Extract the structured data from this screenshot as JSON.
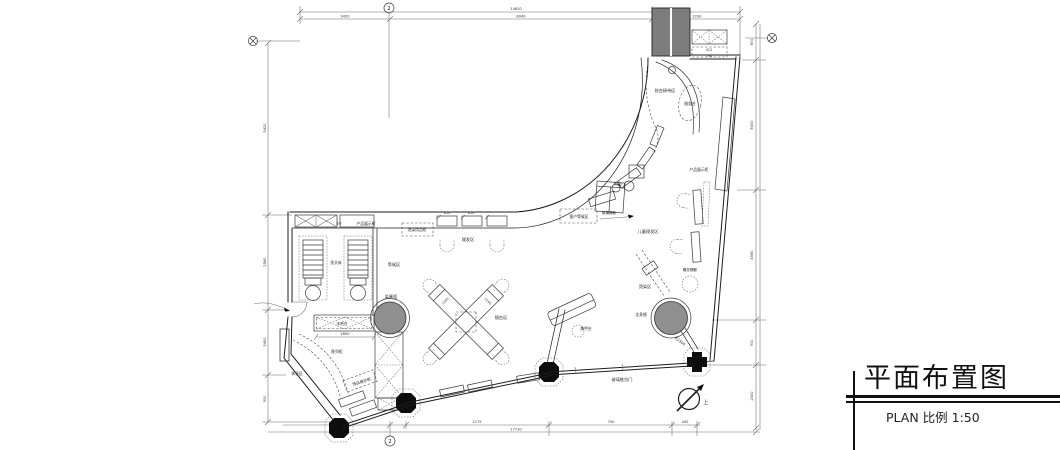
{
  "title_block": {
    "title": "平面布置图",
    "subtitle": "PLAN 比例  1:50"
  },
  "plan": {
    "bubbles": {
      "top": "2",
      "bottom": "2"
    },
    "labels": {
      "tv": "TV",
      "display_top": "产品展示柜",
      "dye_cabinet": "烫染用品柜",
      "shampoo_bed": "洗头床",
      "waiting_area": "等候区",
      "dye_room": "染膏柜",
      "cut_area": "理发区",
      "mirror_island": "镜台区",
      "water_bar": "水吧台",
      "display_cab_left": "陈列柜",
      "jewelry_display": "饰品展示柜",
      "rest_area": "休息区",
      "reception_desk": "服务台",
      "front_desk_area": "前台接待区",
      "display_cab_right": "产品展示柜",
      "guest_waiting": "客户等候区",
      "tea_table": "茶几",
      "glass_partition": "玻璃隔断",
      "kids_cut": "儿童理发区",
      "perm_area": "烫染区",
      "full_mirror": "全身镜",
      "len_2500": "长2500",
      "nail_table": "美甲台",
      "glass_door": "玻璃推拉门",
      "kt": "KT",
      "carved_screen": "雕花隔断",
      "north": "上"
    },
    "dims": {
      "top_total": "14620",
      "top_a": "3420",
      "top_b": "8040",
      "top_c": "2230",
      "left_a": "5420",
      "left_b": "2560",
      "left_c": "3400",
      "left_d": "900",
      "right_e": "800",
      "right_a": "8000",
      "right_d": "4060",
      "right_b": "900",
      "right_c": "2000",
      "bottom_a": "2175",
      "bottom_c": "750",
      "bottom_d": "440",
      "bottom_total": "17710",
      "bar_len": "2600",
      "island_a": "1150",
      "island_b": "1150",
      "cab_a": "850",
      "cab_b": "850",
      "rec_a": "412",
      "rec_b": "794"
    }
  }
}
